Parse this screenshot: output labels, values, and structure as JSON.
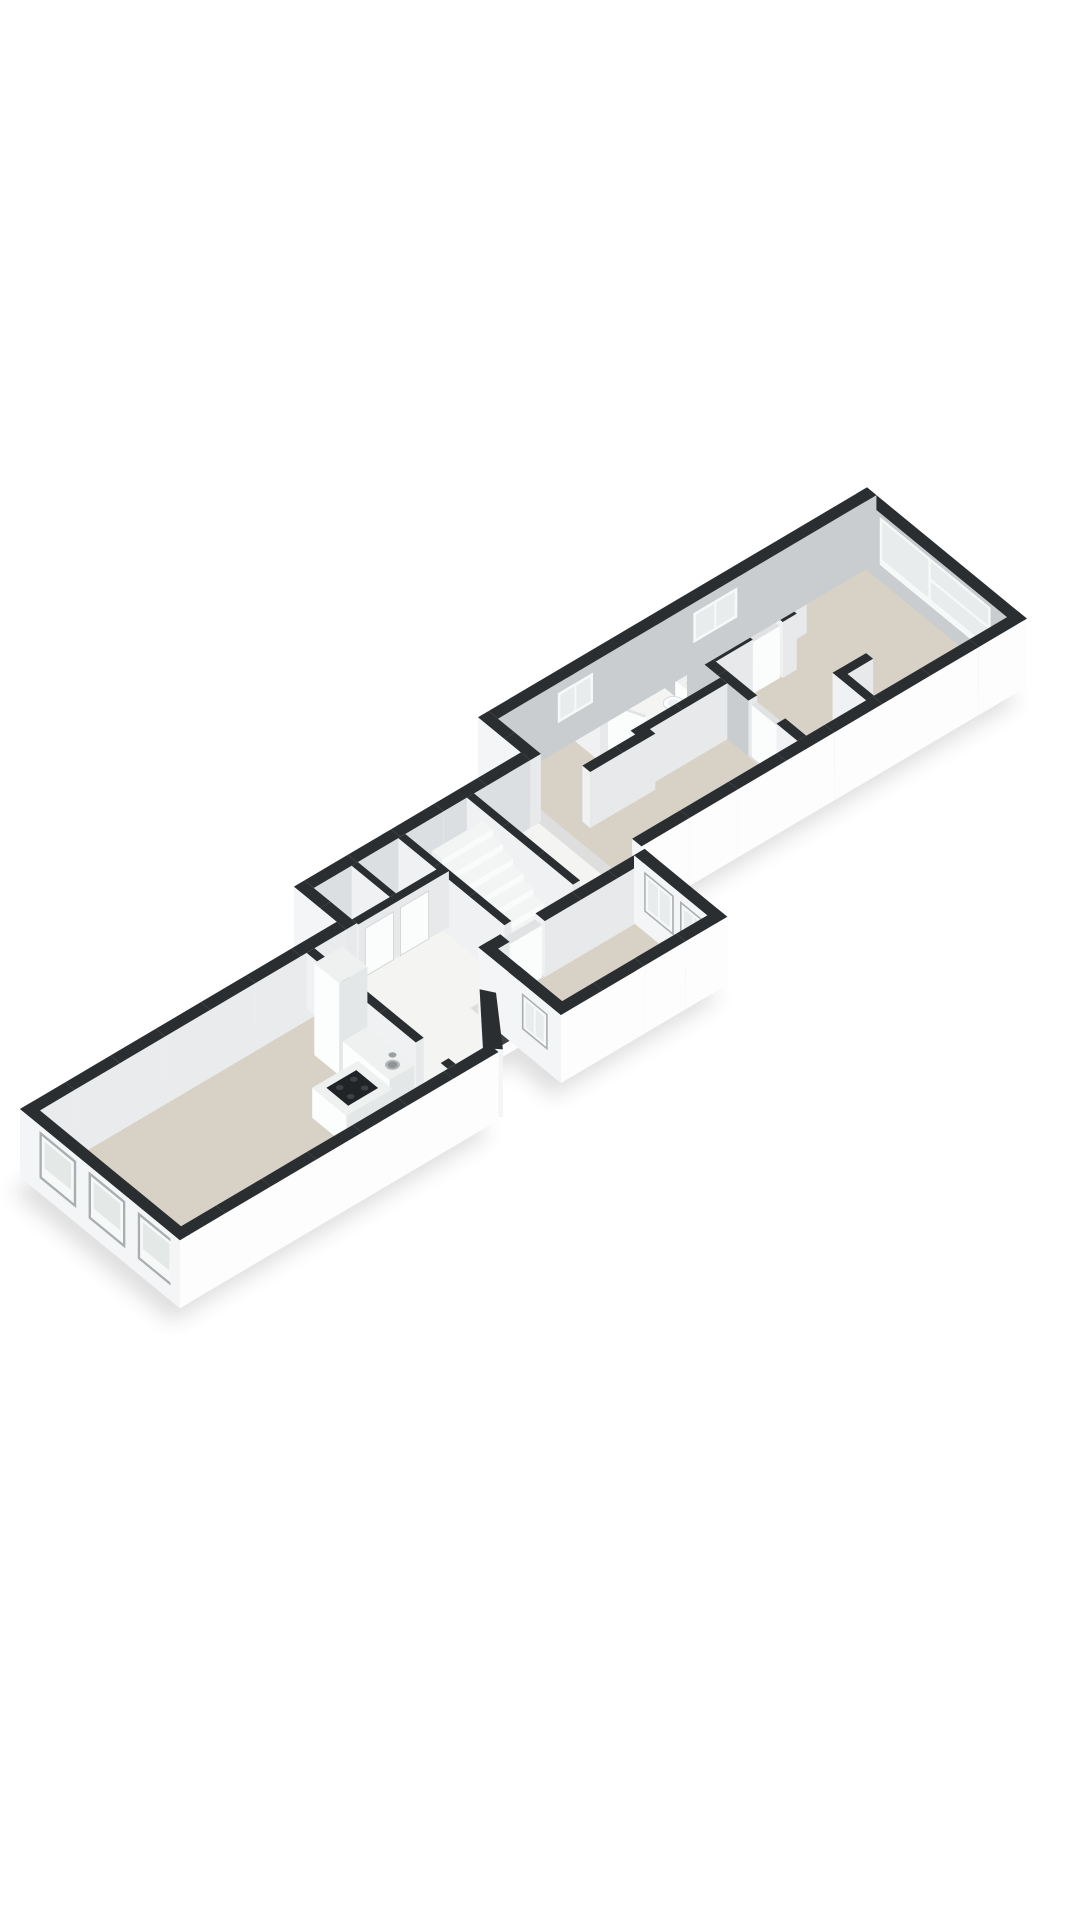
{
  "meta": {
    "title": "3D floor plan",
    "type": "axonometric-floorplan",
    "background": "#ffffff"
  },
  "projection": {
    "ox": 20,
    "oy": 1165,
    "ux": 0.88,
    "uy": -0.52,
    "vx": 0.78,
    "vy": 0.64,
    "wallH": 56,
    "extBase": 12
  },
  "palette": {
    "top": "#2b2e30",
    "extL": "#f4f5f6",
    "extR": "#fdfdfe",
    "intL": "#eff1f2",
    "intR": "#e7e9ea",
    "innerLight": "#e9ebec",
    "innerMid": "#dcdfe1",
    "innerDark": "#c9cdd0",
    "floorBeige": "#d8d2c6",
    "floorWhite": "#f4f4f2",
    "glass": "#e9eced",
    "glassExt": "#e4e8e7",
    "frame": "#f7f8f8",
    "reveal": "#a9aeb0",
    "openingDark": "#3f4346",
    "stairTop": "#f3f4f4",
    "stairFace": "#fafbfb",
    "stairSide": "#eceeef",
    "fixTop": "#eff1f1",
    "fixL": "#fcfdfd",
    "fixR": "#e4e7e8",
    "doorWhite": "#fbfcfc",
    "doorTop": "#e0e2e3",
    "doorEdge": "#d5d8da",
    "cooktop": "#212426",
    "burner": "#3d4144",
    "sinkOuter": "#b3b8ba",
    "sinkInner": "#8e9396",
    "metal": "#9aa0a2",
    "shadow": "#2a2c2e"
  },
  "floors": [
    {
      "name": "floor-living-room",
      "r": [
        12,
        12,
        315,
        193
      ],
      "c": "floorBeige"
    },
    {
      "name": "floor-hall",
      "r": [
        324,
        12,
        360,
        193
      ],
      "c": "floorWhite"
    },
    {
      "name": "floor-hall-front",
      "r": [
        360,
        99,
        424,
        146
      ],
      "c": "floorWhite"
    },
    {
      "name": "floor-corridor",
      "r": [
        360,
        -43,
        618,
        99
      ],
      "c": "floorWhite"
    },
    {
      "name": "floor-middle-room",
      "r": [
        445,
        111,
        610,
        193
      ],
      "c": "floorBeige"
    },
    {
      "name": "floor-bedroom-2",
      "r": [
        630,
        -98,
        810,
        83
      ],
      "c": "floorBeige"
    },
    {
      "name": "floor-bathroom-2",
      "r": [
        708,
        -98,
        810,
        -8
      ],
      "c": "floorWhite"
    },
    {
      "name": "floor-bedroom-1",
      "r": [
        820,
        -98,
        1048,
        83
      ],
      "c": "floorBeige"
    },
    {
      "name": "floor-bathroom-1",
      "r": [
        820,
        -98,
        912,
        -38
      ],
      "c": "floorWhite"
    }
  ],
  "walls": [
    {
      "name": "wall-back-left",
      "r": [
        0,
        0,
        360,
        12
      ],
      "cL": "extL",
      "cR": "innerLight"
    },
    {
      "name": "wall-end-left",
      "r": [
        0,
        0,
        12,
        205
      ],
      "cL": "extL",
      "cR": "extR",
      "dec": [
        {
          "t": "winx",
          "at": 0,
          "a": [
            25,
            72
          ],
          "z": [
            3,
            50
          ],
          "s": "ext"
        },
        {
          "t": "winx",
          "at": 0,
          "a": [
            88,
            135
          ],
          "z": [
            3,
            50
          ],
          "s": "ext"
        },
        {
          "t": "winx",
          "at": 0,
          "a": [
            151,
            198
          ],
          "z": [
            3,
            50
          ],
          "s": "ext"
        }
      ]
    },
    {
      "name": "wall-front-left",
      "r": [
        0,
        193,
        362,
        205
      ],
      "cL": "extL",
      "cR": "extR"
    },
    {
      "name": "wall-front-diagonal",
      "pts": [
        [
          355,
          193
        ],
        [
          400,
          138
        ],
        [
          408,
          150
        ],
        [
          367,
          205
        ]
      ],
      "cL": "extL",
      "cR": "extR"
    },
    {
      "name": "wall-front-porch",
      "r": [
        400,
        138,
        445,
        150
      ],
      "cL": "extL",
      "cR": "extR",
      "dec": [
        {
          "t": "doory",
          "at": 150,
          "a": [
            404,
            434
          ],
          "z": [
            0,
            46
          ]
        }
      ]
    },
    {
      "name": "wall-partition-living",
      "r": [
        315,
        12,
        324,
        152
      ],
      "cL": "intL",
      "cR": "intR"
    },
    {
      "name": "wall-partition-living-b",
      "r": [
        315,
        184,
        324,
        193
      ],
      "cL": "intL",
      "cR": "intR"
    },
    {
      "name": "wall-jog-a",
      "r": [
        360,
        -55,
        372,
        12
      ],
      "cL": "extL",
      "cR": "intR"
    },
    {
      "name": "wall-back-corridor",
      "r": [
        372,
        -55,
        618,
        -43
      ],
      "cL": "extL",
      "cR": "innerMid"
    },
    {
      "name": "wall-closet-front",
      "r": [
        372,
        6,
        475,
        14
      ],
      "cL": "intL",
      "cR": "intR",
      "dec": [
        {
          "t": "paneld",
          "at": 14,
          "a": [
            380,
            412
          ],
          "z": [
            0,
            48
          ]
        },
        {
          "t": "paneld",
          "at": 14,
          "a": [
            420,
            452
          ],
          "z": [
            0,
            48
          ]
        }
      ]
    },
    {
      "name": "wall-closet-divider",
      "r": [
        415,
        -43,
        422,
        6
      ],
      "cL": "intL",
      "cR": "intR"
    },
    {
      "name": "wall-stair-left",
      "r": [
        468,
        -43,
        476,
        93
      ],
      "cL": "intL",
      "cR": "intR"
    },
    {
      "name": "wall-stair-right",
      "r": [
        546,
        -43,
        554,
        93
      ],
      "cL": "intL",
      "cR": "intR"
    },
    {
      "name": "wall-middle-left",
      "r": [
        433,
        99,
        445,
        205
      ],
      "cL": "extL",
      "cR": "intR",
      "dec": [
        {
          "t": "winx",
          "at": 433,
          "a": [
            155,
            188
          ],
          "z": [
            10,
            46
          ],
          "s": "extm"
        }
      ]
    },
    {
      "name": "wall-middle-back",
      "r": [
        433,
        99,
        458,
        111
      ],
      "cL": "intL",
      "cR": "intR"
    },
    {
      "name": "wall-middle-back-b",
      "r": [
        498,
        99,
        622,
        111
      ],
      "cL": "intL",
      "cR": "intR"
    },
    {
      "name": "wall-middle-front",
      "r": [
        433,
        193,
        622,
        205
      ],
      "cL": "extL",
      "cR": "extR"
    },
    {
      "name": "wall-middle-right",
      "r": [
        610,
        99,
        622,
        205
      ],
      "cL": "extL",
      "cR": "intR",
      "dec": [
        {
          "t": "winx",
          "at": 610,
          "a": [
            112,
            150
          ],
          "z": [
            8,
            48
          ],
          "s": "extm"
        },
        {
          "t": "winx",
          "at": 610,
          "a": [
            158,
            192
          ],
          "z": [
            8,
            48
          ],
          "s": "extm"
        }
      ]
    },
    {
      "name": "wall-jog-b",
      "r": [
        618,
        -110,
        630,
        -43
      ],
      "cL": "extL",
      "cR": "intR"
    },
    {
      "name": "wall-back-right",
      "r": [
        630,
        -110,
        1060,
        -98
      ],
      "cL": "extL",
      "cR": "innerDark",
      "dec": [
        {
          "t": "winy",
          "at": -98,
          "a": [
            698,
            738
          ],
          "z": [
            16,
            46
          ],
          "s": "int"
        },
        {
          "t": "winy",
          "at": -98,
          "a": [
            852,
            902
          ],
          "z": [
            16,
            46
          ],
          "s": "int"
        }
      ]
    },
    {
      "name": "wall-front-right",
      "r": [
        622,
        83,
        1060,
        95
      ],
      "cL": "extL",
      "cR": "extR"
    },
    {
      "name": "wall-end-right",
      "r": [
        1048,
        -110,
        1060,
        95
      ],
      "cL": "innerDark",
      "cR": "extR",
      "dec": [
        {
          "t": "bigwin",
          "at": 1048,
          "a": [
            -80,
            62
          ],
          "z": [
            4,
            52
          ]
        }
      ]
    },
    {
      "name": "wall-backzone",
      "r": [
        648,
        -10,
        722,
        0
      ],
      "cL": "intL",
      "cR": "intR"
    },
    {
      "name": "wall-bathroom2-left",
      "r": [
        708,
        -98,
        717,
        -55
      ],
      "cL": "intL",
      "cR": "intR"
    },
    {
      "name": "wall-bathroom2-front",
      "r": [
        708,
        -16,
        810,
        -7
      ],
      "cL": "intL",
      "cR": "intR"
    },
    {
      "name": "wall-divider-bed12",
      "r": [
        810,
        -98,
        820,
        20
      ],
      "cL": "innerDark",
      "cR": "intR"
    },
    {
      "name": "wall-divider-bed12-b",
      "r": [
        810,
        56,
        820,
        83
      ],
      "cL": "intL",
      "cR": "intR"
    },
    {
      "name": "wall-bathroom1-front",
      "r": [
        820,
        -42,
        862,
        -33
      ],
      "cL": "intL",
      "cR": "intR"
    },
    {
      "name": "wall-bathroom1-front-b",
      "r": [
        896,
        -42,
        912,
        -33
      ],
      "cL": "intL",
      "cR": "intR"
    },
    {
      "name": "wall-bathroom1-right",
      "r": [
        904,
        -98,
        912,
        -42
      ],
      "cL": "intL",
      "cR": "intR"
    },
    {
      "name": "wall-closet-apex",
      "r": [
        912,
        -70,
        948,
        -61
      ],
      "cL": "intL",
      "cR": "intR"
    },
    {
      "name": "wall-closet-bed1",
      "r": [
        888,
        40,
        897,
        83
      ],
      "cL": "intL",
      "cR": "intR"
    },
    {
      "name": "wall-closet-bed1-b",
      "r": [
        888,
        40,
        926,
        49
      ],
      "cL": "intL",
      "cR": "intR"
    }
  ],
  "doors": [
    {
      "name": "door-middle-back",
      "r": [
        460,
        100.5,
        496,
        109.5
      ],
      "h": 52
    },
    {
      "name": "door-bedroom-1",
      "r": [
        812,
        22,
        818,
        54
      ],
      "h": 52
    },
    {
      "name": "door-bathroom-1",
      "r": [
        864,
        -41.5,
        894,
        -34.5
      ],
      "h": 52
    },
    {
      "name": "door-bathroom-2-open",
      "pts": [
        [
          717,
          -55
        ],
        [
          720,
          -56
        ],
        [
          734,
          -25
        ],
        [
          731,
          -24
        ]
      ],
      "h": 52
    }
  ],
  "stairs": {
    "name": "staircase",
    "x1": 483,
    "x2": 541,
    "yFront": 87,
    "treads": 8,
    "depth": 13,
    "rise": 6.5
  },
  "kitchen": {
    "cabinet": {
      "name": "kitchen-tall-cabinet",
      "r": [
        283,
        58,
        315,
        90
      ],
      "h": 92
    },
    "counter": {
      "name": "kitchen-counter",
      "r": [
        287,
        90,
        315,
        150
      ],
      "h": 32
    },
    "island": {
      "name": "kitchen-island",
      "r": [
        231,
        114,
        283,
        158
      ],
      "h": 30
    },
    "cooktop": {
      "name": "cooktop",
      "r": [
        240,
        122,
        274,
        150
      ],
      "z": 30,
      "burners": [
        [
          249,
          129
        ],
        [
          265,
          129
        ],
        [
          249,
          143
        ],
        [
          265,
          143
        ]
      ],
      "burnerR": 4.6
    },
    "sink": {
      "name": "kitchen-sink",
      "c": [
        301,
        138
      ],
      "z": 32,
      "r": 9
    },
    "faucet": {
      "name": "kitchen-faucet",
      "c": [
        309,
        129
      ],
      "z": 32,
      "r": 2.4
    }
  },
  "bathroom1": {
    "counter": {
      "name": "washbasin-counter",
      "r": [
        822,
        -98,
        900,
        -78
      ],
      "h": 30
    },
    "sink": {
      "name": "washbasin-sink",
      "c": [
        866,
        -88
      ],
      "z": 30,
      "r": 8.5
    },
    "faucet": {
      "name": "washbasin-faucet",
      "c": [
        873,
        -94
      ],
      "z": 30,
      "r": 2.2
    }
  },
  "toilet": {
    "name": "toilet",
    "tank": [
      796,
      -58,
      808,
      -36
    ],
    "tankH": 34,
    "bowlC": [
      784,
      -47
    ],
    "bowlR": 12,
    "bowlZ": 24
  },
  "shadowRects": [
    [
      0,
      0,
      362,
      205
    ],
    [
      360,
      -55,
      622,
      150
    ],
    [
      433,
      99,
      622,
      205
    ],
    [
      618,
      -110,
      1060,
      95
    ]
  ]
}
